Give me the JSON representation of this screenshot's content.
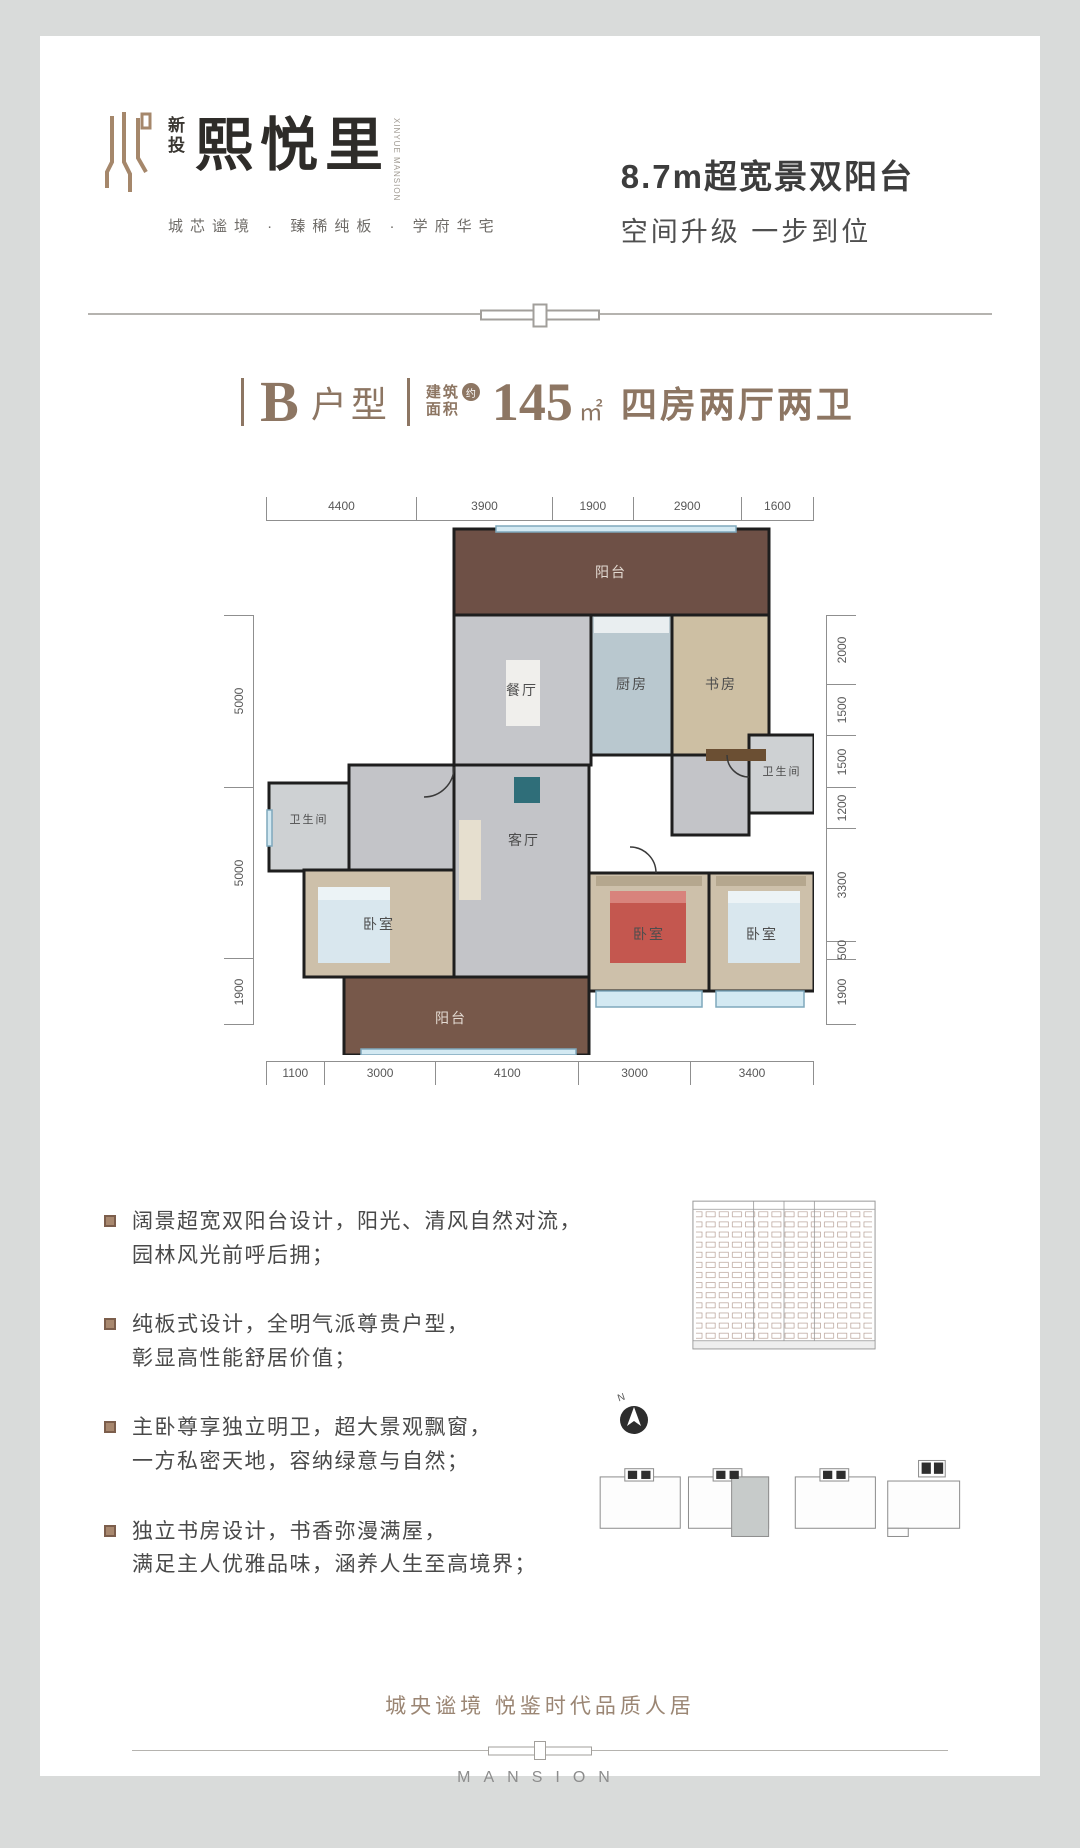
{
  "brand": {
    "sub_line1": "新",
    "sub_line2": "投",
    "name": "熙悦里",
    "side_text": "XINYUE MANSION",
    "tagline": "城芯谧境 · 臻稀纯板 · 学府华宅"
  },
  "promo": {
    "headline": "8.7m超宽景双阳台",
    "subline": "空间升级  一步到位"
  },
  "unit_bar": {
    "unit": "B",
    "unit_word": "户型",
    "area_label_top": "建筑",
    "area_label_bottom": "面积",
    "approx": "约",
    "area_value": "145",
    "area_unit": "㎡",
    "rooms_text": "四房两厅两卫"
  },
  "floorplan": {
    "dims_top": [
      "4400",
      "3900",
      "1900",
      "2900",
      "1600"
    ],
    "dims_bottom": [
      "1100",
      "3000",
      "4100",
      "3000",
      "3400"
    ],
    "dims_left": [
      "5000",
      "5000",
      "1900"
    ],
    "dims_right": [
      "2000",
      "1500",
      "1500",
      "1200",
      "3300",
      "500",
      "1900"
    ],
    "rooms": {
      "balcony_top": "阳台",
      "dining": "餐厅",
      "kitchen": "厨房",
      "study": "书房",
      "bath_right": "卫生间",
      "bath_left": "卫生间",
      "living": "客厅",
      "bed_left": "卧室",
      "bed_mid": "卧室",
      "bed_right": "卧室",
      "balcony_bottom": "阳台"
    },
    "colors": {
      "wall": "#1e1e1e",
      "marble": "#c5c6ca",
      "wood": "#cdc0aa",
      "brick": "#6e5046",
      "tile": "#b9c8cf",
      "window": "#d3e9f2"
    }
  },
  "features": {
    "items": [
      {
        "line1": "阔景超宽双阳台设计，阳光、清风自然对流，",
        "line2": "园林风光前呼后拥；"
      },
      {
        "line1": "纯板式设计，全明气派尊贵户型，",
        "line2": "彰显高性能舒居价值；"
      },
      {
        "line1": "主卧尊享独立明卫，超大景观飘窗，",
        "line2": "一方私密天地，容纳绿意与自然；"
      },
      {
        "line1": "独立书房设计，书香弥漫满屋，",
        "line2": "满足主人优雅品味，涵养人生至高境界；"
      }
    ]
  },
  "graphics": {
    "compass_label": "N"
  },
  "footer": {
    "slogan": "城央谧境  悦鉴时代品质人居",
    "brand_en": "MANSION"
  }
}
